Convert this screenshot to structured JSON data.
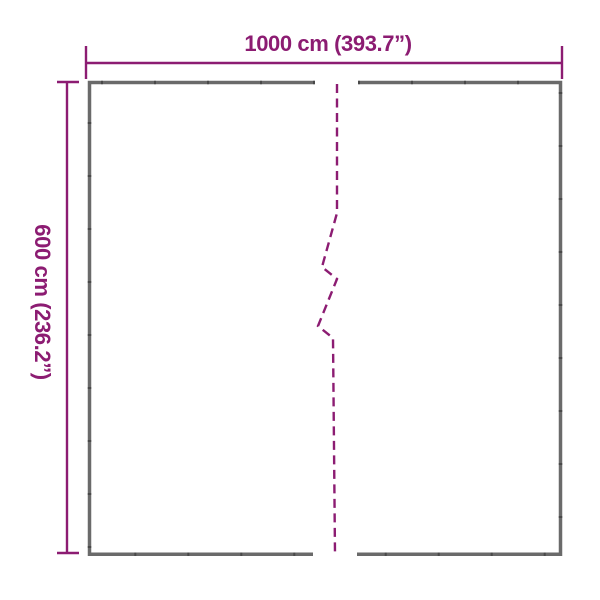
{
  "diagram": {
    "kind": "product-dimension-diagram",
    "width_dimension": {
      "label": "1000 cm (393.7”)",
      "value_cm": 1000,
      "value_inches": 393.7
    },
    "height_dimension": {
      "label": "600 cm (236.2”)",
      "value_cm": 600,
      "value_inches": 236.2
    },
    "colors": {
      "accent": "#8C1C72",
      "outline": "#6A6A6A",
      "outline_fleck": "#3F3F3F",
      "background": "#FFFFFF"
    }
  }
}
